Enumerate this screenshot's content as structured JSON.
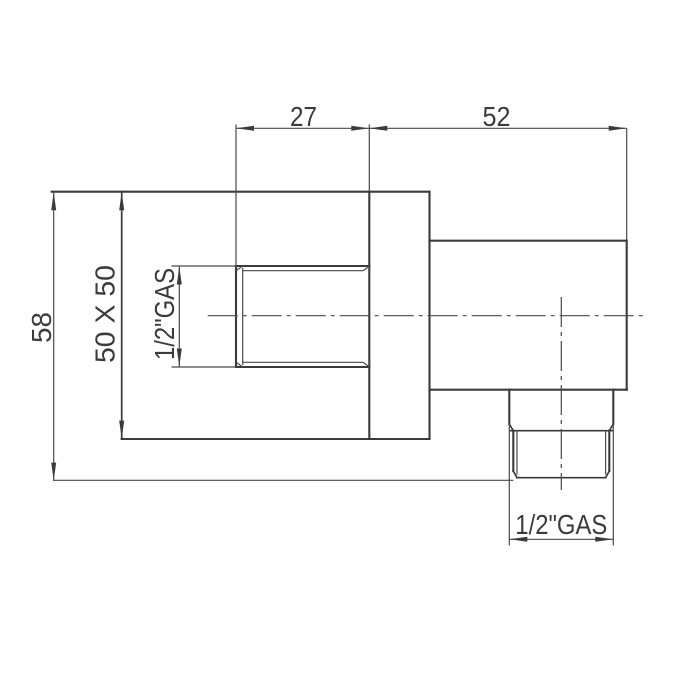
{
  "drawing": {
    "colors": {
      "background": "#ffffff",
      "line": "#3b3b3b",
      "thin_line": "#4a4a4a",
      "text": "#3b3b3b"
    },
    "dimensions": {
      "top_left_width": "27",
      "top_right_width": "52",
      "left_height": "58",
      "plate_size": "50 X 50",
      "side_thread": "1/2\"GAS",
      "bottom_thread": "1/2\"GAS"
    }
  }
}
